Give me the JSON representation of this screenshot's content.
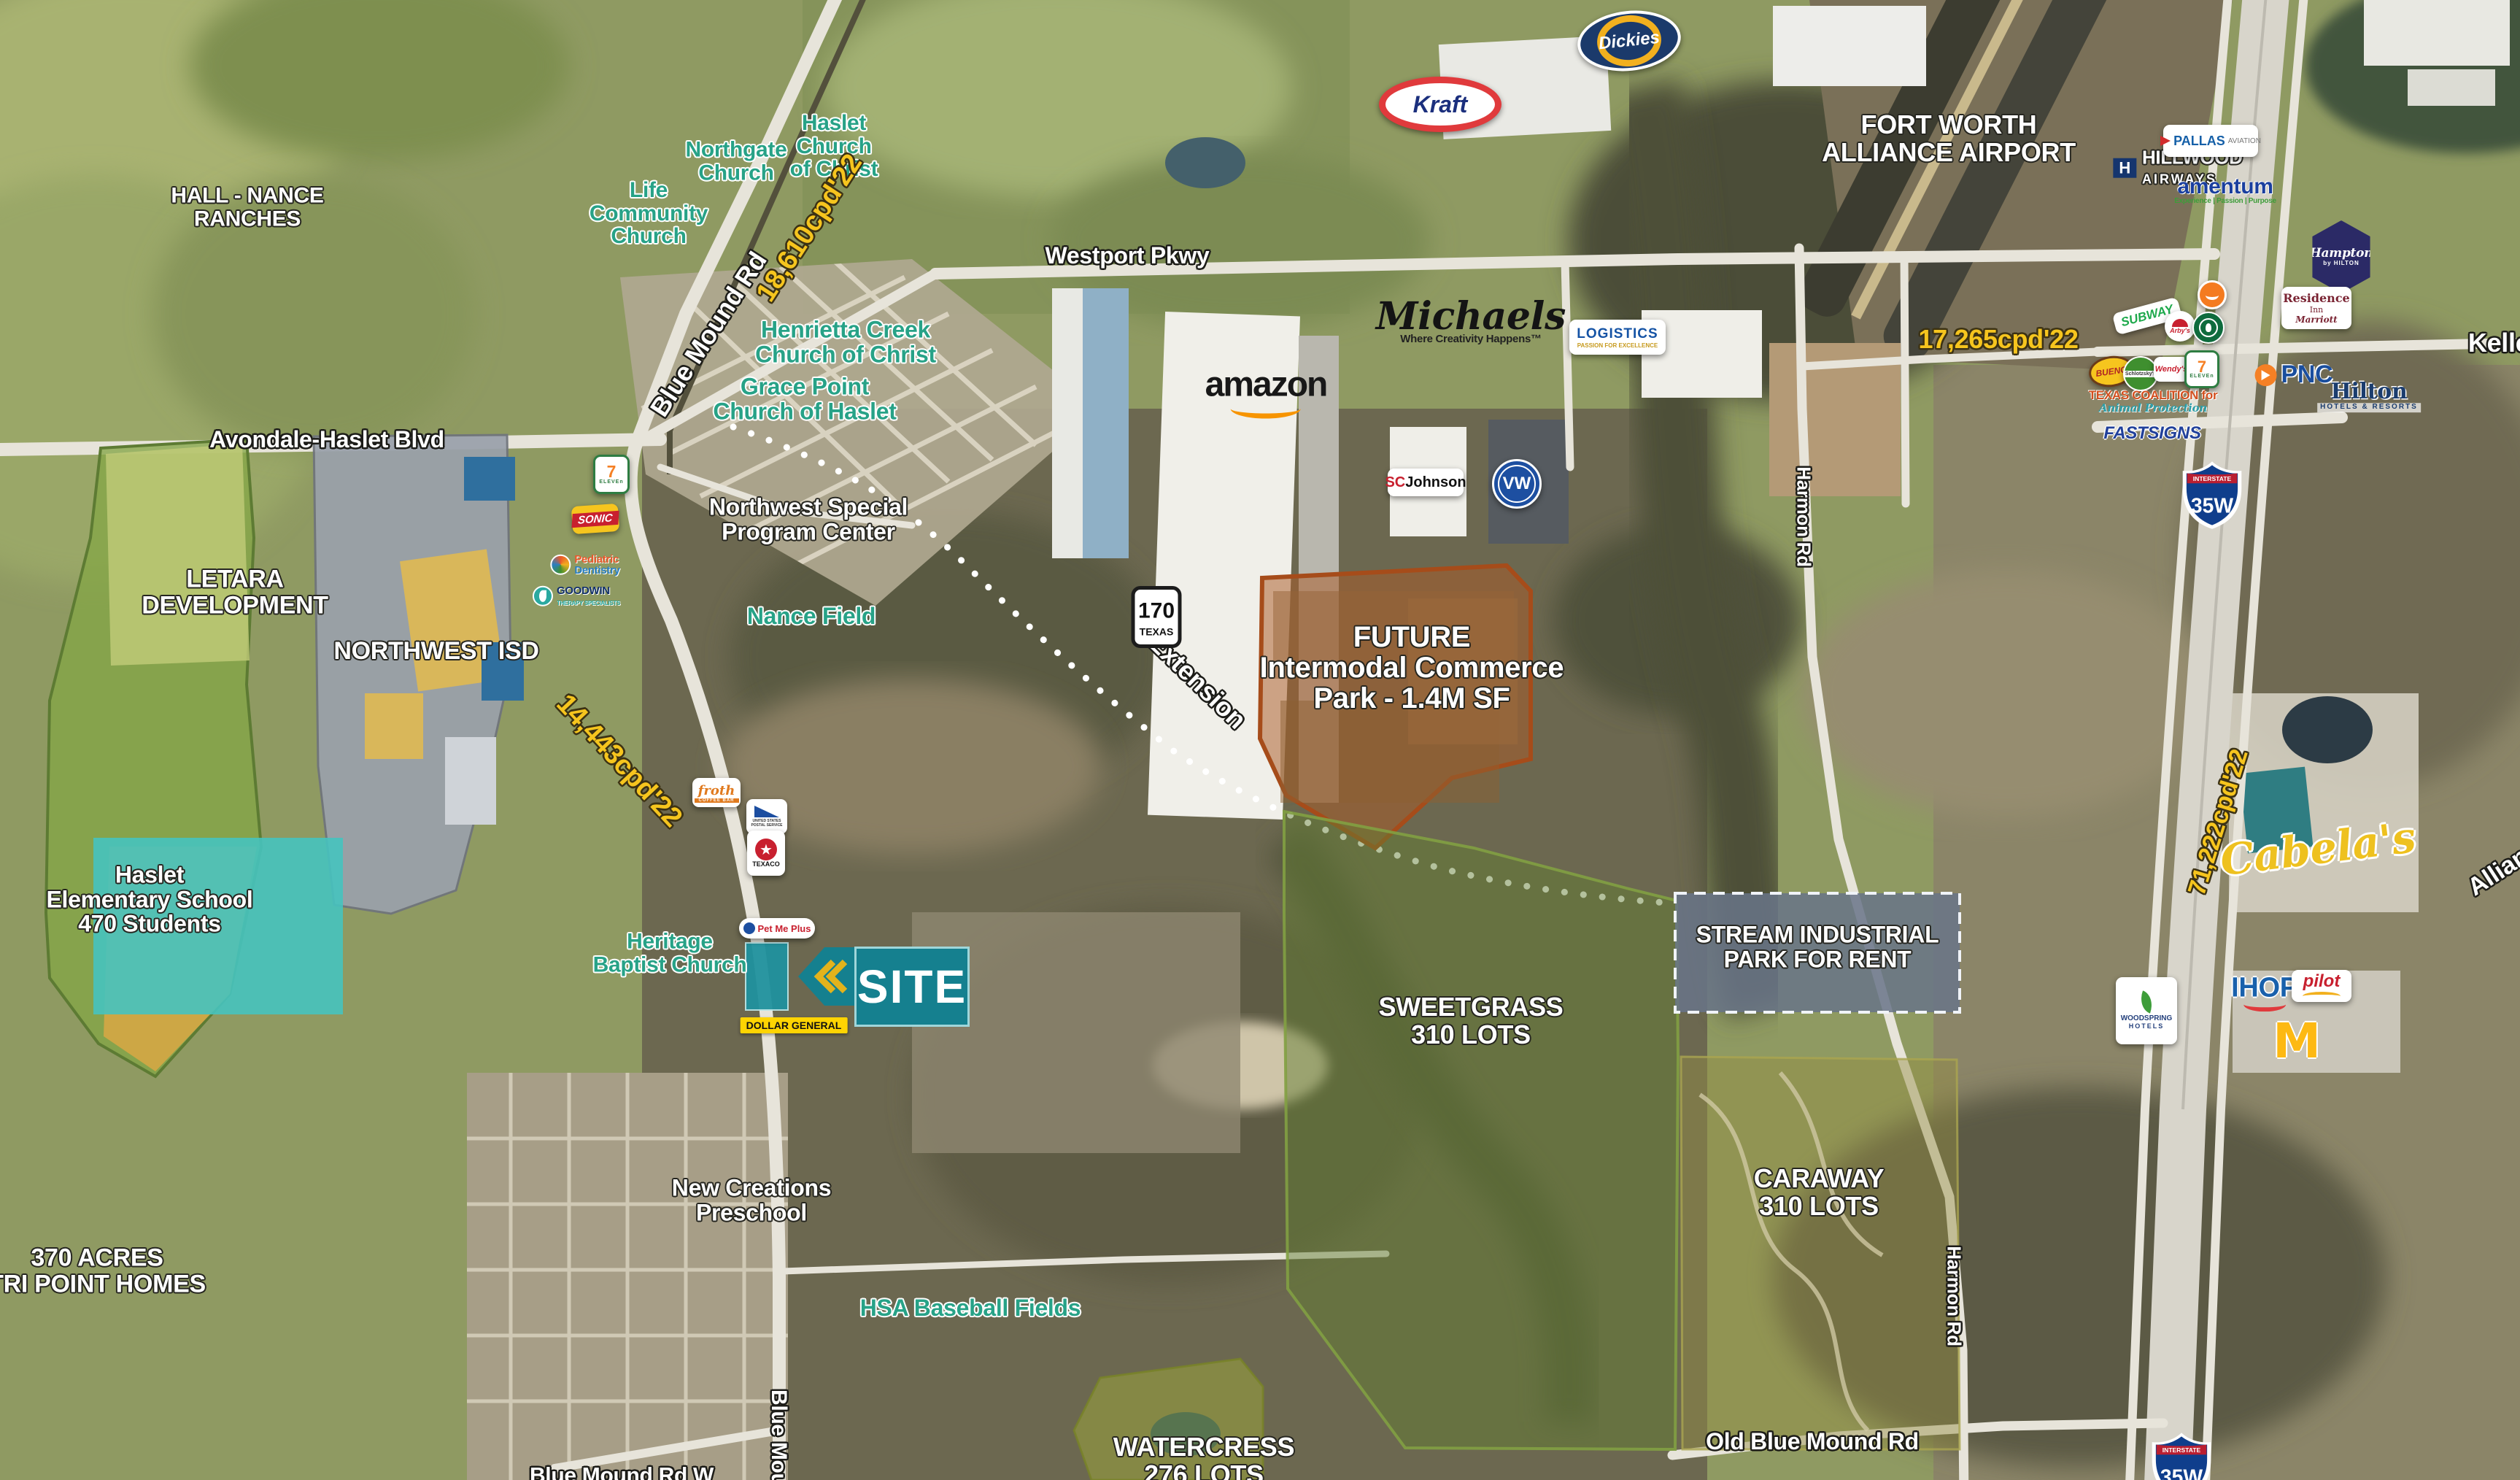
{
  "regions": {
    "hall_nance": "HALL - NANCE\nRANCHES",
    "letara": "LETARA\nDEVELOPMENT",
    "northwest_isd": "NORTHWEST ISD",
    "haslet_elementary": "Haslet\nElementary School\n470 Students",
    "tri_point": "370 ACRES\nTRI POINT HOMES",
    "future_intermodal": "FUTURE\nIntermodal Commerce\nPark - 1.4M SF",
    "sweetgrass": "SWEETGRASS\n310 LOTS",
    "caraway": "CARAWAY\n310 LOTS",
    "watercress": "WATERCRESS\n276 LOTS",
    "stream_industrial": "STREAM INDUSTRIAL\nPARK FOR RENT"
  },
  "places": {
    "northgate_church": "Northgate\nChurch",
    "haslet_church_of_christ": "Haslet\nChurch\nof Christ",
    "life_community_church": "Life\nCommunity\nChurch",
    "henrietta_creek": "Henrietta Creek\nChurch of Christ",
    "grace_point": "Grace Point\nChurch of Haslet",
    "northwest_special_program": "Northwest Special\nProgram Center",
    "nance_field": "Nance Field",
    "heritage_baptist": "Heritage\nBaptist Church",
    "new_creations": "New Creations\nPreschool",
    "hsa_baseball": "HSA Baseball Fields",
    "fort_worth_alliance_airport": "FORT WORTH\nALLIANCE AIRPORT"
  },
  "roads": {
    "westport_pkwy": "Westport Pkwy",
    "avondale_haslet_blvd": "Avondale-Haslet Blvd",
    "blue_mound_rd": "Blue Mound Rd",
    "blue_mound_rd_south": "Blue Mound Rd",
    "blue_mound_rd_w": "Blue Mound Rd W",
    "old_blue_mound_rd": "Old Blue Mound Rd",
    "harmon_rd_north": "Harmon Rd",
    "harmon_rd_south": "Harmon Rd",
    "keller": "Keller",
    "alliance": "Alliance",
    "extension": "Extension"
  },
  "traffic_counts": {
    "blue_mound_rd": "18,610cpd'22",
    "keller_haslet_rd": "17,265cpd'22",
    "avondale_haslet_blvd": "14,443cpd'22",
    "i35w": "71,222cpd'22"
  },
  "shields": {
    "interstate": "INTERSTATE",
    "i35w": "35W",
    "tx170": "170",
    "tx170_state": "TEXAS"
  },
  "site": {
    "label": "SITE"
  },
  "logos": {
    "kraft": "Kraft",
    "dickies": "Dickies",
    "amazon": "amazon",
    "michaels": {
      "name": "Michaels",
      "tagline": "Where Creativity Happens™"
    },
    "logistics": {
      "name": "LOGISTICS",
      "tagline": "PASSION FOR EXCELLENCE"
    },
    "scjohnson": {
      "sc": "SC",
      "johnson": "Johnson"
    },
    "vw": "VW",
    "hillwood": {
      "h": "H",
      "name": "HILLWOOD",
      "sub": "AIRWAYS"
    },
    "pallas": {
      "name": "PALLAS",
      "sub": "AVIATION"
    },
    "amentum": {
      "name": "amentum",
      "tagline": "Experience | Passion | Purpose"
    },
    "hampton": {
      "name": "Hampton",
      "sub": "by HILTON"
    },
    "residence_inn": {
      "line1": "Residence",
      "line2": "Inn",
      "line3": "Marriott"
    },
    "subway": "SUBWAY",
    "arbys": "Arby's",
    "bueno": "BUENO",
    "schlotzskys": "Schlotzsky's",
    "wendys": "Wendy's",
    "seven_eleven": {
      "seven": "7",
      "eleven": "ELEVEn"
    },
    "texas_coalition": {
      "line1": "TEXAS COALITION for",
      "line2": "Animal Protection"
    },
    "fastsigns": "FASTSIGNS",
    "pnc": "PNC",
    "hilton": {
      "name": "Hilton",
      "sub": "HOTELS & RESORTS"
    },
    "sonic": "SONIC",
    "pediatric": {
      "line1": "Pediatric",
      "line2": "Dentistry"
    },
    "goodwin": {
      "name": "GOODWIN",
      "sub": "THERAPY SPECIALISTS"
    },
    "froth": {
      "name": "froth",
      "sub": "COFFEE BAR"
    },
    "usps": "UNITED STATES POSTAL SERVICE",
    "texaco": "TEXACO",
    "petmeplus": "Pet Me Plus",
    "dollar_general": "DOLLAR GENERAL",
    "woodspring": {
      "name": "WOODSPRING",
      "sub": "HOTELS"
    },
    "ihop": "IHOP",
    "pilot": "pilot",
    "mcdonalds": "M",
    "cabelas": "Cabela's"
  }
}
